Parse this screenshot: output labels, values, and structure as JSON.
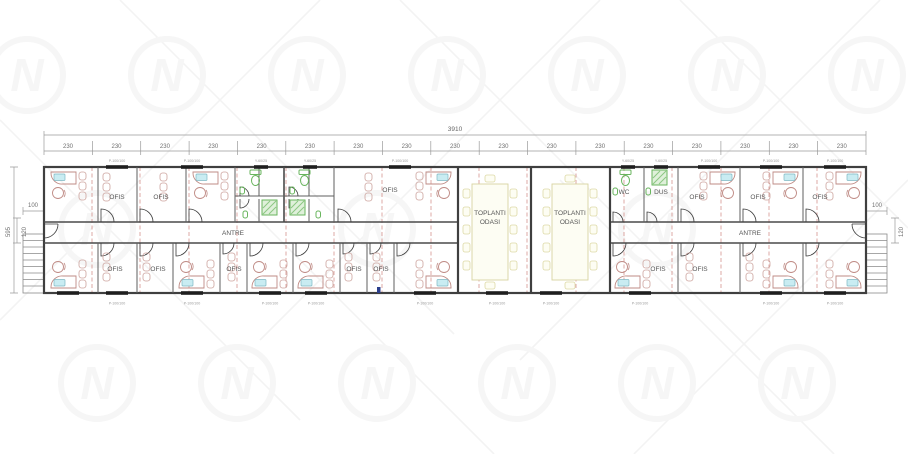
{
  "dims": {
    "total": "3910",
    "bay": "230",
    "height_total": "595",
    "entry_width": "100",
    "entry_depth": "120"
  },
  "windows": {
    "office_label": "P-100/100",
    "wet_label": "Y-60/25"
  },
  "rooms": {
    "office": "OFIS",
    "hall": "ANTRE",
    "meeting_line1": "TOPLANTI",
    "meeting_line2": "ODASI",
    "wc": "WC",
    "shower": "DUS"
  },
  "watermark": {
    "letter": "N"
  },
  "colors": {
    "wall": "#3f3f3f",
    "module_grid_red": "#c4655e",
    "furniture_rose": "#bf8b85",
    "fixture_green": "#69b55e",
    "meeting_tan": "#d8d3a0",
    "monitor_cyan": "#c9ecf2",
    "dimension_gray": "#9a9a9a"
  }
}
